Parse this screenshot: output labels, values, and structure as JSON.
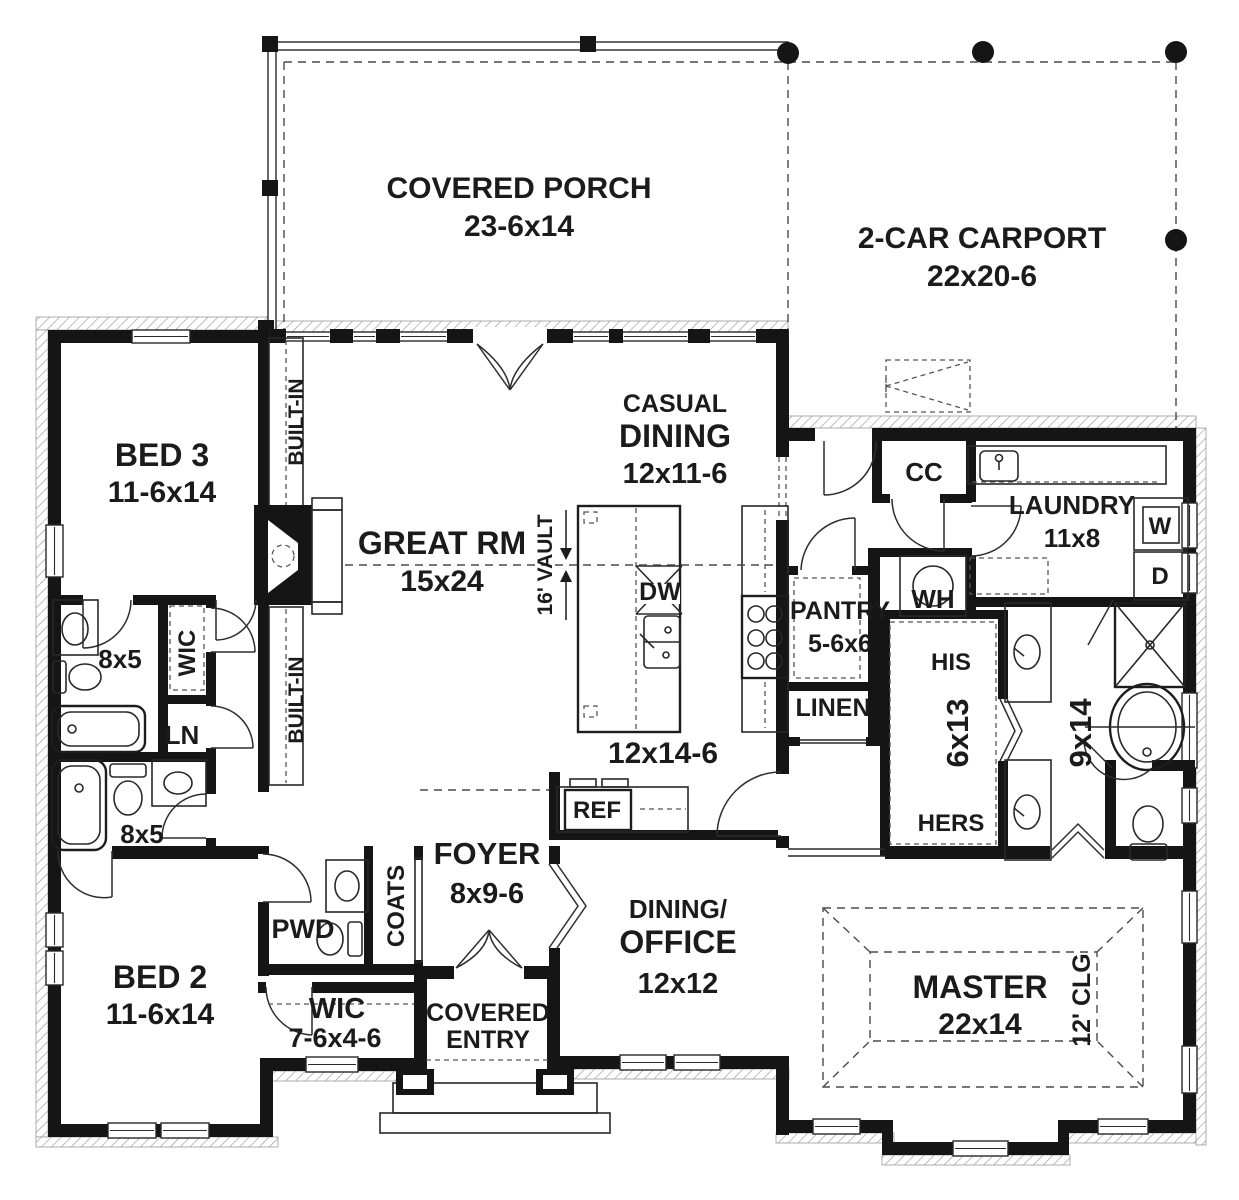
{
  "colors": {
    "wall": "#151515",
    "background": "#ffffff",
    "hatch": "#9a9a9a"
  },
  "labels": {
    "covered_porch": "COVERED PORCH",
    "covered_porch_size": "23-6x14",
    "carport": "2-CAR CARPORT",
    "carport_size": "22x20-6",
    "bed3": "BED 3",
    "bed3_size": "11-6x14",
    "bed2": "BED 2",
    "bed2_size": "11-6x14",
    "great_rm": "GREAT RM",
    "great_rm_size": "15x24",
    "vault": "16' VAULT",
    "casual1": "CASUAL",
    "casual2": "DINING",
    "casual_size": "12x11-6",
    "builtin_upper": "BUILT-IN",
    "builtin_lower": "BUILT-IN",
    "dw": "DW",
    "kitchen_size": "12x14-6",
    "ref": "REF",
    "pantry": "PANTRY",
    "pantry_size": "5-6x6",
    "linen": "LINEN",
    "cc": "CC",
    "wh": "WH",
    "laundry": "LAUNDRY",
    "laundry_size": "11x8",
    "washer": "W",
    "dryer": "D",
    "his": "HIS",
    "hers": "HERS",
    "his_hers_size": "6x13",
    "master_bath_size": "9x14",
    "bath1_size": "8x5",
    "bath2_size": "8x5",
    "wic1": "WIC",
    "ln": "LN",
    "foyer": "FOYER",
    "foyer_size": "8x9-6",
    "pwd": "PWD",
    "coats": "COATS",
    "wic2": "WIC",
    "wic2_size": "7-6x4-6",
    "covered_entry1": "COVERED",
    "covered_entry2": "ENTRY",
    "office1": "DINING/",
    "office2": "OFFICE",
    "office_size": "12x12",
    "master": "MASTER",
    "master_size": "22x14",
    "master_clg": "12' CLG"
  }
}
